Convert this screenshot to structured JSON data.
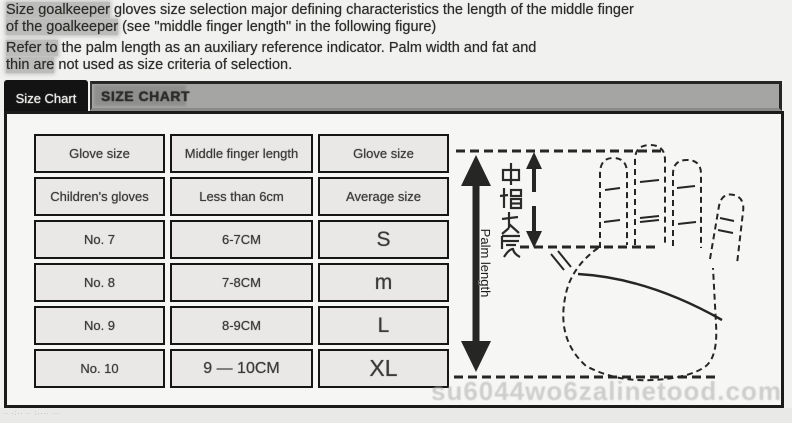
{
  "intro": {
    "lines": [
      {
        "lead": "Size goalkeeper",
        "rest": " gloves size selection major defining characteristics the length of the middle finger"
      },
      {
        "lead": "of the goalkeeper",
        "rest": " (see \"middle finger length\" in the following figure)"
      },
      {
        "lead": "Refer to",
        "rest": " the palm length as an auxiliary reference indicator. Palm width and fat and"
      },
      {
        "lead": "thin are",
        "rest": " not used as size criteria of selection."
      }
    ]
  },
  "tabs": {
    "size_chart_tab": "Size Chart",
    "bar_title": "SIZE CHART"
  },
  "chart_data": {
    "type": "table",
    "title": "SIZE CHART",
    "columns": [
      "Glove size",
      "Middle finger length",
      "Glove size"
    ],
    "rows": [
      [
        "Glove size",
        "Middle finger length",
        "Glove size"
      ],
      [
        "Children's gloves",
        "Less than 6cm",
        "Average size"
      ],
      [
        "No. 7",
        "6-7CM",
        "S"
      ],
      [
        "No. 8",
        "7-8CM",
        "m"
      ],
      [
        "No. 9",
        "8-9CM",
        "L"
      ],
      [
        "No. 10",
        "9 — 10CM",
        "XL"
      ]
    ]
  },
  "hand_diagram": {
    "palm_length_label": "Palm length",
    "middle_finger_label_cn": "中指长度"
  },
  "watermark_text": "su6044wo6zalinetood.com",
  "footer_micro_text": "·· ·:·· ·· :···· ···",
  "colors": {
    "tab_background": "#131313",
    "bar_background": "#a5a5a3",
    "panel_border": "#1b1b19",
    "cell_background": "#e9e8e6",
    "cell_border": "#161614",
    "highlight": "#bcbcba",
    "watermark": "#aeaeac"
  }
}
